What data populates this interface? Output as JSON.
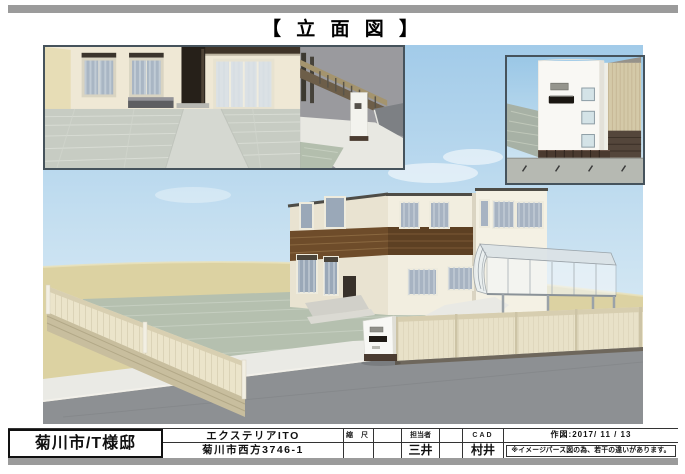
{
  "header": {
    "title": "【 立 面 図 】"
  },
  "title_block": {
    "project_name": "菊川市/T様邸",
    "company_name": "エクステリアITO",
    "company_address": "菊川市西方3746-1",
    "scale": {
      "label": "縮 尺",
      "value": ""
    },
    "staff": {
      "label": "担当者",
      "value": "三井"
    },
    "cad": {
      "label": "CAD",
      "value": "村井"
    },
    "date_line": "作図:2017/ 11 / 13",
    "note": "※イメージパース図の為、若干の違いがあります。"
  },
  "palette": {
    "frame_bar_gray": "#9b9b9b",
    "sky_top": "#a2cbe9",
    "sky_bottom": "#e9f3f8",
    "sand": "#dcd2a2",
    "yard_tile_green": "#b5c0af",
    "road_gray": "#8d9093",
    "concrete_white": "#eaeae5",
    "fence_panel_cream": "#ebe4ca",
    "block_wall_tan": "#c8be9e",
    "house_wall": "#f2eee0",
    "house_wall_shade": "#e9e3d1",
    "wood_band_brown": "#5d4023",
    "window_glass": "#a7b3c2",
    "canopy_translucent": "#e9eff2",
    "gatepost_white": "#f8f8f5",
    "mail_slot_black": "#201b16",
    "inset_border": "#46535c"
  }
}
